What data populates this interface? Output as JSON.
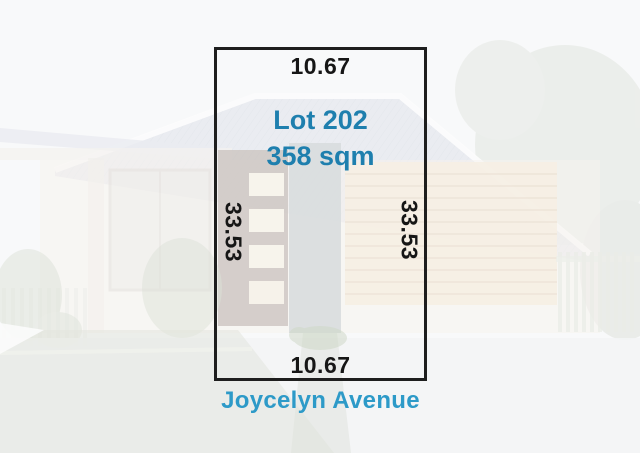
{
  "diagram": {
    "lot_label": "Lot 202",
    "area": "358 sqm",
    "frontage_top": "10.67",
    "frontage_bottom": "10.67",
    "depth_left": "33.53",
    "depth_right": "33.53",
    "street": "Joycelyn Avenue"
  },
  "colors": {
    "lot_text": "#1e7fae",
    "street_text": "#2d9ac8",
    "dimension_text": "#161616",
    "boundary": "#1e1e1e"
  }
}
